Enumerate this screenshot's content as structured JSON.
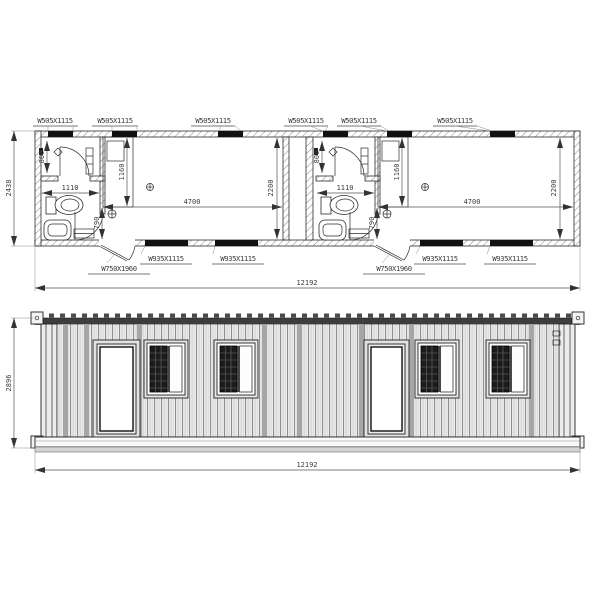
{
  "doc": {
    "type": "container-house-drawing"
  },
  "plan": {
    "overall_depth": "2438",
    "overall_length": "12192",
    "top_window_labels": [
      "W505X1115",
      "W505X1115",
      "W505X1115",
      "W505X1115",
      "W505X1115",
      "W505X1115"
    ],
    "bottom_window_labels": [
      "W935X1115",
      "W935X1115",
      "W935X1115",
      "W935X1115"
    ],
    "door_labels": [
      "W750X1960",
      "W750X1960"
    ],
    "units": [
      {
        "bath_depth": "800",
        "bath_width": "1110",
        "bed_length": "1160",
        "entry_width": "790",
        "room_length": "4700",
        "room_depth": "2200"
      },
      {
        "bath_depth": "800",
        "bath_width": "1110",
        "bed_length": "1160",
        "entry_width": "790",
        "room_length": "4700",
        "room_depth": "2200"
      }
    ]
  },
  "elevation": {
    "height": "2896",
    "length": "12192"
  },
  "colors": {
    "line": "#2b2b2b",
    "window_glass": "#111111",
    "siding_light": "#efefef",
    "siding_dark": "#8f8f8f",
    "seam": "#a6a6a6",
    "pane_dark": "#1c1c1c"
  }
}
